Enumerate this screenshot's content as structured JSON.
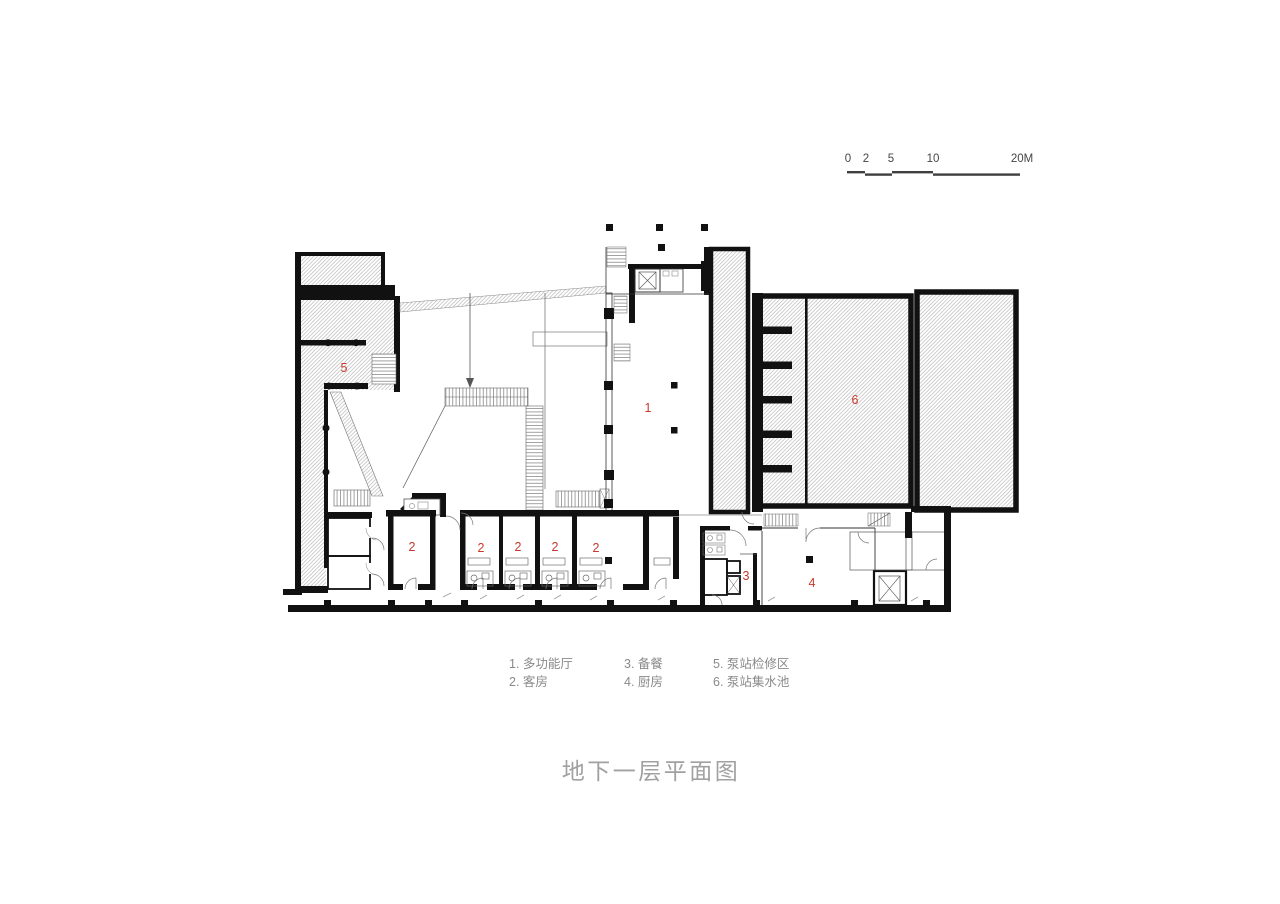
{
  "title": {
    "text": "地下一层平面图"
  },
  "scale_bar": {
    "labels": [
      "0",
      "2",
      "5",
      "10",
      "20M"
    ]
  },
  "legend": {
    "columns": [
      {
        "rows": [
          "1. 多功能厅",
          "2. 客房"
        ]
      },
      {
        "rows": [
          "3. 备餐",
          "4. 厨房"
        ]
      },
      {
        "rows": [
          "5. 泵站检修区",
          "6. 泵站集水池"
        ]
      }
    ]
  },
  "plan": {
    "room_markers": [
      "5",
      "1",
      "6",
      "2",
      "2",
      "2",
      "2",
      "2",
      "3",
      "4"
    ]
  },
  "colors": {
    "accent_red": "#c8392b",
    "wall_black": "#111111",
    "legend_gray": "#8a8a8a",
    "title_gray": "#a1a1a1",
    "scale_gray": "#454545"
  }
}
